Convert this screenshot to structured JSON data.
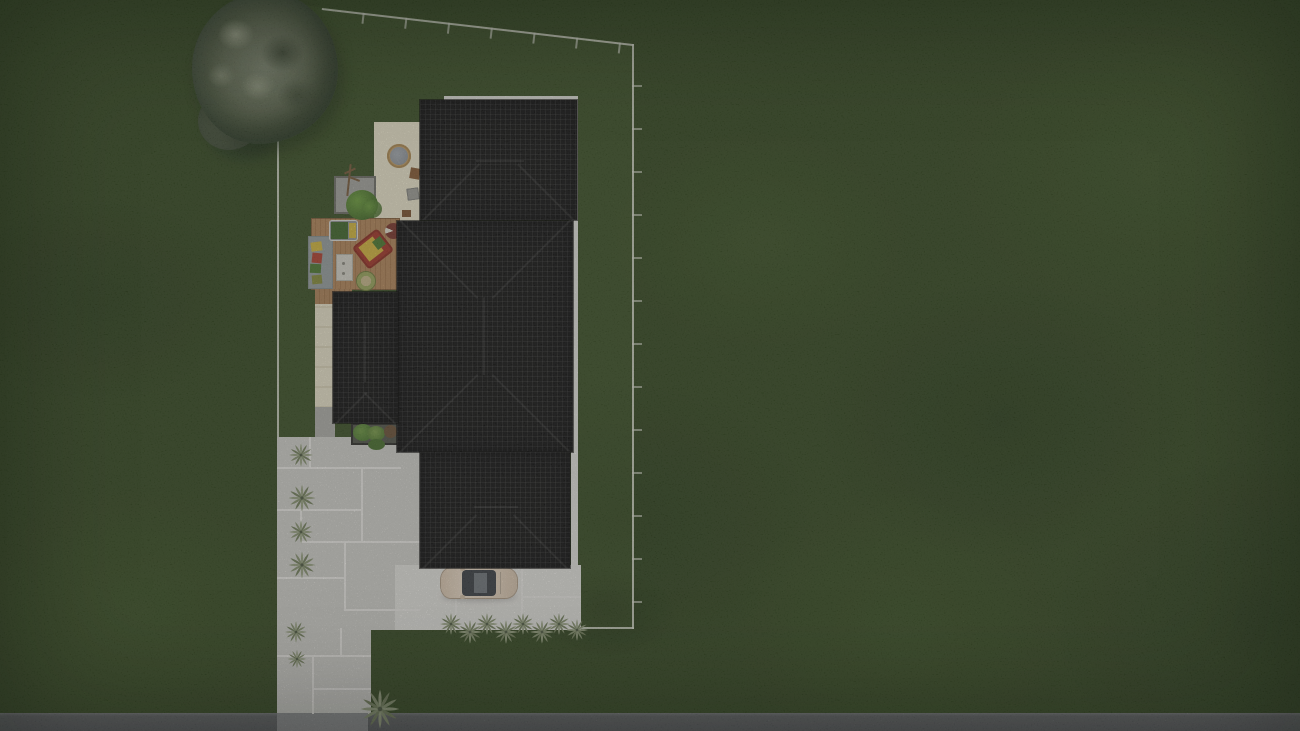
{
  "scene": {
    "title": "Aerial top-down 3D render of a residential lot site plan",
    "view": "top-down",
    "visible_text": "none",
    "elements": [
      {
        "name": "lawn",
        "color": "#33481f"
      },
      {
        "name": "property-boundary",
        "color": "#e2e5d7",
        "shape": "polygon with survey tick marks on top and right sides"
      },
      {
        "name": "house-roofs",
        "color": "#121212",
        "sections": [
          "top-wing",
          "main-wing",
          "left-small-wing",
          "bottom-wing"
        ],
        "texture": "dark tile grid with hip lines",
        "trim_color": "#e8e8e2"
      },
      {
        "name": "rear-patio",
        "color": "#f2edd3",
        "items": [
          "round-fire-table",
          "stool",
          "grill-square"
        ]
      },
      {
        "name": "wood-deck",
        "color": "#b78a5c",
        "items": [
          "lounge-chair",
          "day-bed",
          "area-rug-with-pillows",
          "coffee-table",
          "round-pouf",
          "bbq-kettle"
        ]
      },
      {
        "name": "gravel-planter",
        "color": "#a8a8a2",
        "items": [
          "sapling",
          "green-bush"
        ]
      },
      {
        "name": "shrub-planter",
        "colors": [
          "#4e7c30",
          "#6e9a42"
        ]
      },
      {
        "name": "paved-courtyard",
        "color": "#d6d5d0",
        "texture": "large slabs with light joints"
      },
      {
        "name": "bright-concrete-pad",
        "color": "#eae9e4"
      },
      {
        "name": "driveway",
        "color": "#d6d5d0"
      },
      {
        "name": "street",
        "color": "#5e6064"
      },
      {
        "name": "driveway-apron",
        "color": "#8f9093"
      },
      {
        "name": "car",
        "body_color": "#ead8c2",
        "glass_color": "#3a3e44"
      },
      {
        "name": "large-tree",
        "canopy_color": "#7e8870"
      },
      {
        "name": "palm-shrubs",
        "color": "#96a37f",
        "groups": [
          "left-edge-column",
          "row-below-car",
          "driveway-corner"
        ]
      }
    ]
  },
  "palette": {
    "grass": "#33481f",
    "roof": "#121212",
    "roof_trim": "#e8e8e2",
    "pavement": "#d6d5d0",
    "bright_concrete": "#eae9e4",
    "patio_cream": "#f2edd3",
    "deck_wood": "#b78a5c",
    "road": "#5e6064",
    "boundary": "#e2e5d7",
    "tree_canopy": "#7e8870",
    "shrub_green": "#4e7c30",
    "car_body": "#ead8c2"
  }
}
